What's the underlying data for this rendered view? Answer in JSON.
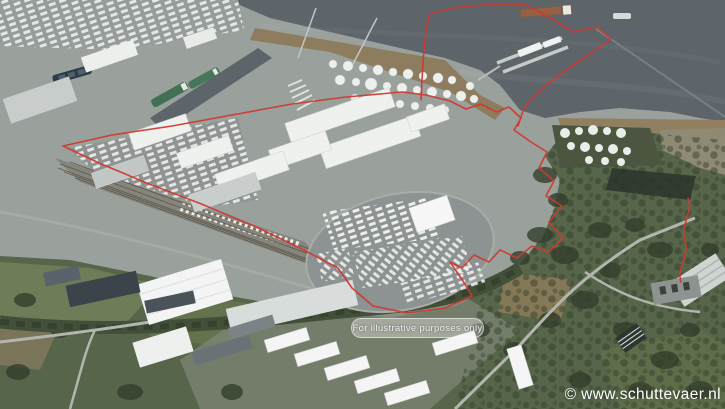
{
  "photo": {
    "watermark": "© www.schuttevaer.nl",
    "disclaimer_label": "For illustrative purposes only"
  },
  "palette": {
    "water": "#5d646a",
    "land_gray": "#9aa09c",
    "asphalt": "#8d9292",
    "riverbank_tan": "#8d7c5e",
    "field_green": "#57664a",
    "tree_green": "#343f2c",
    "building_white": "#f0f2f0",
    "boundary_red": "#ce3a30",
    "watermark_white": "#ffffff"
  }
}
